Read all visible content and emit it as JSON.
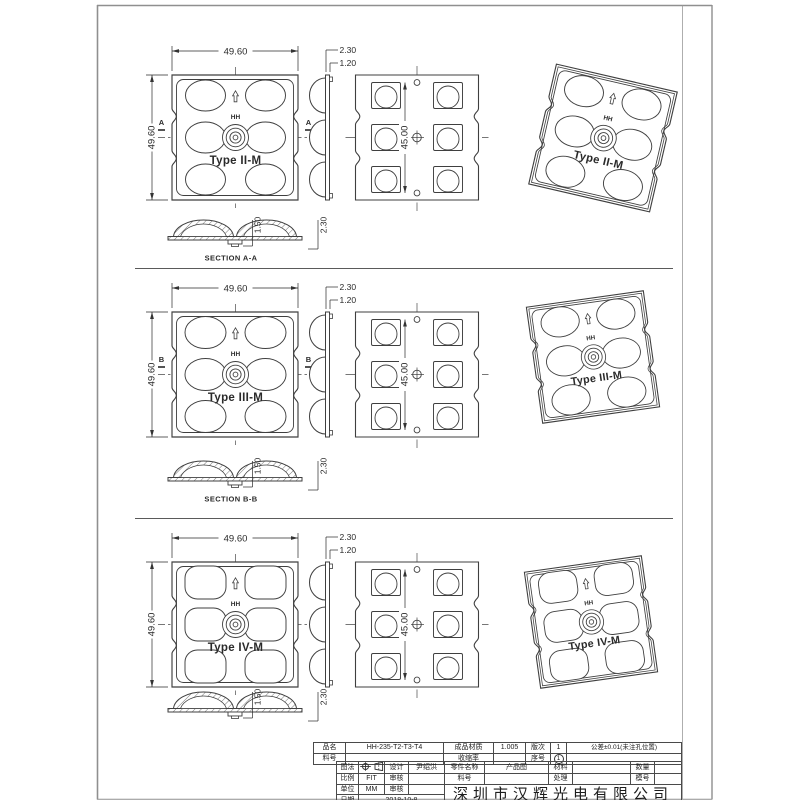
{
  "colors": {
    "line": "#3f3f3f",
    "dim": "#2a2a2a",
    "center": "#4a4a4a",
    "frame": "#8f8f8f",
    "bg": "#ffffff"
  },
  "rows": [
    {
      "type_label": "Type II-M",
      "logo": "HH",
      "view_letter": "A",
      "section_title": "SECTION A-A",
      "lens": "ellipse",
      "dims": {
        "width": "49.60",
        "height": "49.60",
        "thickness": "2.30",
        "base_thickness": "1.20",
        "pitch": "45.00",
        "lens_height": "1.50",
        "total_height": "2.30"
      }
    },
    {
      "type_label": "Type III-M",
      "logo": "HH",
      "view_letter": "B",
      "section_title": "SECTION B-B",
      "lens": "ellipse",
      "dims": {
        "width": "49.60",
        "height": "49.60",
        "thickness": "2.30",
        "base_thickness": "1.20",
        "pitch": "45.00",
        "lens_height": "1.50",
        "total_height": "2.30"
      }
    },
    {
      "type_label": "Type IV-M",
      "logo": "HH",
      "view_letter": "",
      "section_title": "",
      "lens": "rounded-square",
      "dims": {
        "width": "49.60",
        "height": "49.60",
        "thickness": "2.30",
        "base_thickness": "1.20",
        "pitch": "45.00",
        "lens_height": "1.50",
        "total_height": "2.30"
      }
    }
  ],
  "tb": {
    "r1": [
      "品名",
      "HH-235-T2-T3-T4",
      "成品材质",
      "1.005",
      "版次",
      "1",
      "公差±0.01(未注孔位置)"
    ],
    "r2": [
      "料号",
      "",
      "收缩率",
      "",
      "序号",
      "1",
      ""
    ],
    "r3": [
      "图法",
      "",
      "设计",
      "尹绍洪",
      "零件名称",
      "产品图",
      "材料",
      "",
      "数量",
      ""
    ],
    "r4": [
      "比例",
      "FIT",
      "审核",
      "",
      "料号",
      "",
      "处理",
      "",
      "模号",
      ""
    ],
    "r5": [
      "单位",
      "MM",
      "审核",
      ""
    ],
    "r6": [
      "日期",
      "2018-10-8"
    ],
    "company": "深圳市汉辉光电有限公司",
    "projection_icons": [
      "target-projection-icon",
      "cone-projection-icon"
    ]
  }
}
